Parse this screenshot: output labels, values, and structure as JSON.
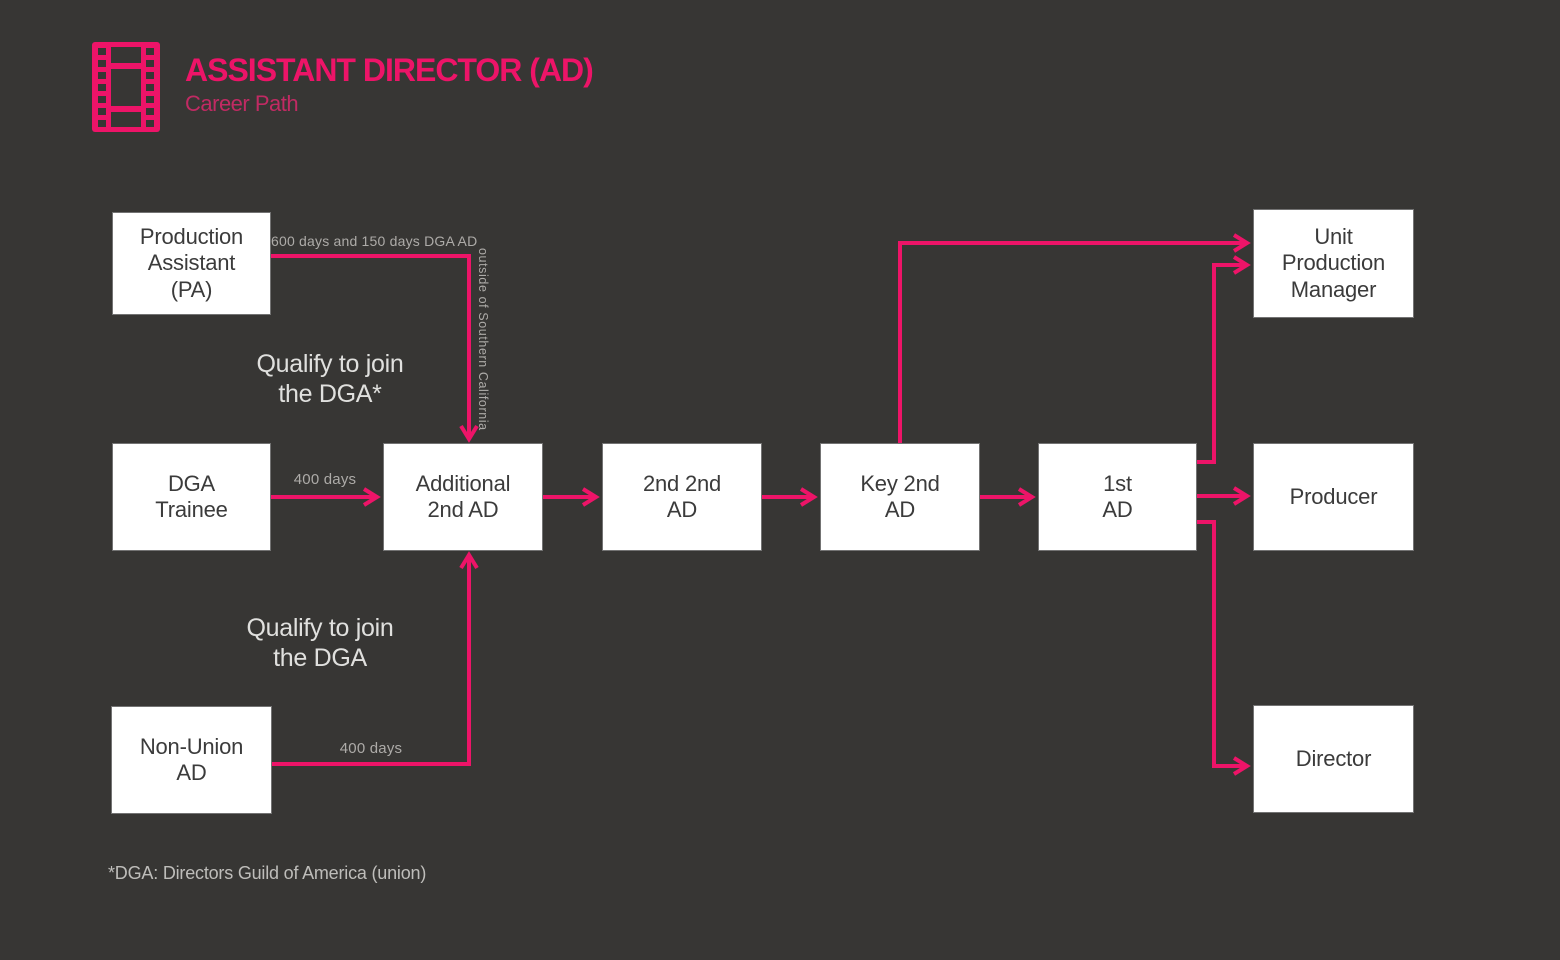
{
  "header": {
    "title": "ASSISTANT DIRECTOR (AD)",
    "subtitle": "Career Path"
  },
  "colors": {
    "background": "#373634",
    "accent": "#ED1468",
    "subtitle_pink": "#C12A63",
    "box_fill": "#FFFFFF",
    "box_text": "#3B3B3B",
    "label_gray": "#ADABA8",
    "annotation_gray": "#E0E0DE",
    "footnote_gray": "#BEBDBA"
  },
  "nodes": {
    "production_assistant": {
      "label": "Production\nAssistant\n(PA)"
    },
    "dga_trainee": {
      "label": "DGA\nTrainee"
    },
    "non_union_ad": {
      "label": "Non-Union\nAD"
    },
    "additional_2nd_ad": {
      "label": "Additional\n2nd AD"
    },
    "second_second_ad": {
      "label": "2nd 2nd\nAD"
    },
    "key_2nd_ad": {
      "label": "Key 2nd\nAD"
    },
    "first_ad": {
      "label": "1st\nAD"
    },
    "unit_production_manager": {
      "label": "Unit\nProduction\nManager"
    },
    "producer": {
      "label": "Producer"
    },
    "director": {
      "label": "Director"
    }
  },
  "edge_labels": {
    "pa_to_additional": "600 days and 150 days DGA AD",
    "outside_socal": "outside of Southern California",
    "trainee_days": "400 days",
    "non_union_days": "400 days"
  },
  "annotations": {
    "qualify_dga_star": "Qualify to join\nthe DGA*",
    "qualify_dga": "Qualify to join\nthe DGA"
  },
  "footnote": "*DGA: Directors Guild of America (union)"
}
